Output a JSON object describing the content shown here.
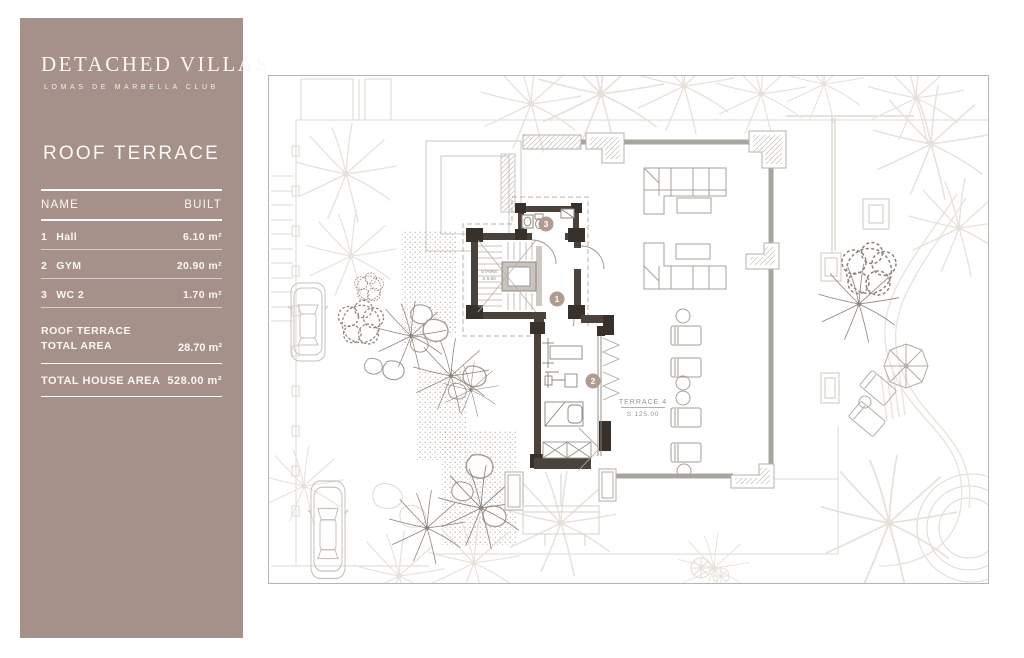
{
  "sidebar": {
    "brand_title": "DETACHED VILLAS",
    "brand_subtitle": "LOMAS DE MARBELLA CLUB",
    "page_title": "ROOF TERRACE",
    "accent_color": "#a5918a",
    "table": {
      "col_name": "NAME",
      "col_built": "BUILT",
      "rows": [
        {
          "num": "1",
          "name": "Hall",
          "value": "6.10 m²"
        },
        {
          "num": "2",
          "name": "GYM",
          "value": "20.90 m²"
        },
        {
          "num": "3",
          "name": "WC 2",
          "value": "1.70 m²"
        }
      ],
      "subtotal_label_line1": "ROOF TERRACE",
      "subtotal_label_line2": "TOTAL AREA",
      "subtotal_value": "28.70 m²",
      "total_label": "TOTAL HOUSE AREA",
      "total_value": "528.00 m²"
    }
  },
  "plan": {
    "markers": [
      {
        "num": "1"
      },
      {
        "num": "2"
      },
      {
        "num": "3"
      }
    ],
    "terrace_label": "TERRACE 4",
    "terrace_area": "S 125.00",
    "stairs_label": "STAIRS",
    "stairs_area": "S 5.60"
  }
}
